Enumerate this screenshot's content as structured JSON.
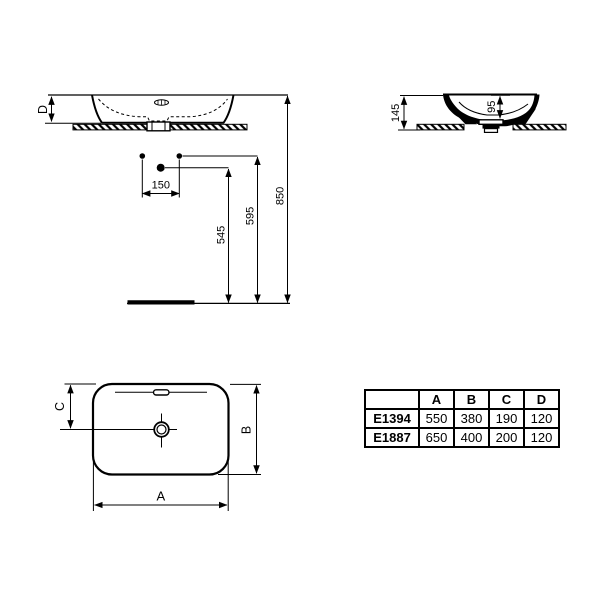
{
  "title": "Washbasin technical drawing",
  "colors": {
    "line": "#000000",
    "background": "#ffffff"
  },
  "views": {
    "front": {
      "d_label": "D"
    },
    "section": {
      "total_height": "145",
      "bowl_depth": "95"
    },
    "install": {
      "tap_spacing": "150",
      "drain_height": "545",
      "supply_height": "595",
      "rim_height": "850"
    },
    "plan": {
      "width_label": "A",
      "depth_label": "B",
      "center_offset_label": "C"
    }
  },
  "table": {
    "columns": [
      "",
      "A",
      "B",
      "C",
      "D"
    ],
    "rows": [
      {
        "model": "E1394",
        "values": [
          "550",
          "380",
          "190",
          "120"
        ]
      },
      {
        "model": "E1887",
        "values": [
          "650",
          "400",
          "200",
          "120"
        ]
      }
    ]
  }
}
